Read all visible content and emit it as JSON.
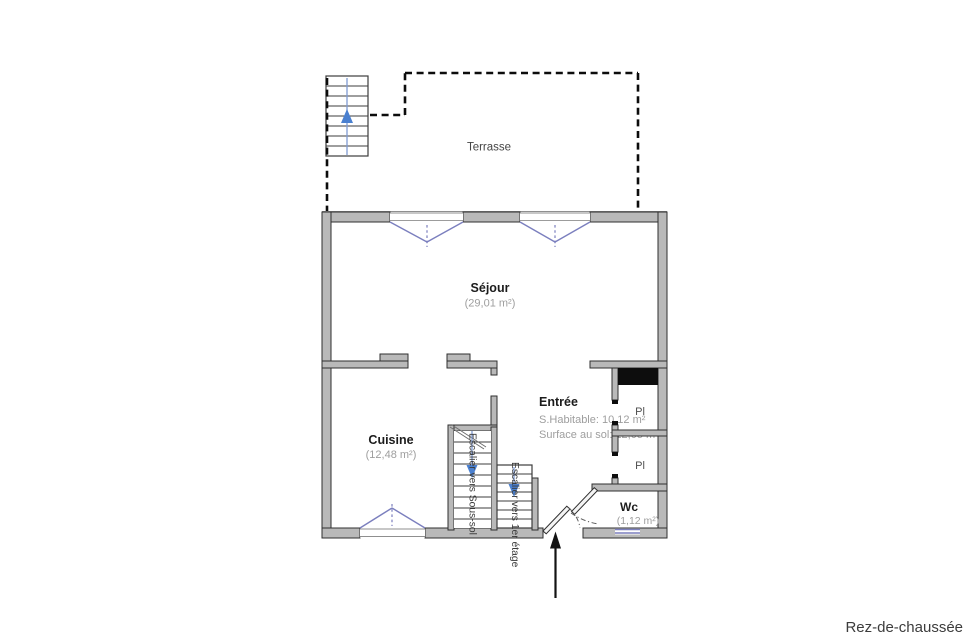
{
  "title": "Rez-de-chaussée",
  "terrace": {
    "label": "Terrasse"
  },
  "rooms": {
    "sejour": {
      "name": "Séjour",
      "area": "(29,01 m²)"
    },
    "cuisine": {
      "name": "Cuisine",
      "area": "(12,48 m²)"
    },
    "entree": {
      "name": "Entrée",
      "line1": "S.Habitable: 10,12 m²",
      "line2": "Surface au sol: 12,05 m²"
    },
    "wc": {
      "name": "Wc",
      "area": "(1,12 m²)"
    },
    "closet1": {
      "name": "Pl"
    },
    "closet2": {
      "name": "Pl"
    }
  },
  "stairs": {
    "basement": {
      "label": "Escalier vers Sous-sol"
    },
    "first_floor": {
      "label": "Escalier vers 1er étage"
    }
  },
  "colors": {
    "wall_fill": "#b9b9b9",
    "wall_stroke": "#2f2f2f",
    "window_blue": "#7b7fbe",
    "arrow_blue": "#4a80d0",
    "text_dark": "#1c1c1c",
    "text_gray": "#9e9e9e",
    "terrace_text": "#454545",
    "floor_label": "#3c3c3c"
  }
}
